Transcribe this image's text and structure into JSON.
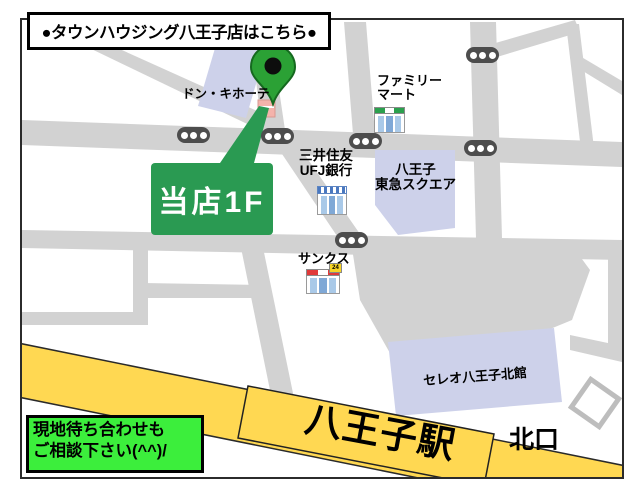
{
  "title_box": {
    "text": "●タウンハウジング八王子店はこちら●"
  },
  "bubble": {
    "label": "当店1F"
  },
  "note_box": {
    "line1": "現地待ち合わせも",
    "line2": "ご相談下さい(^^)/"
  },
  "station": {
    "name": "八王子駅",
    "exit": "北口"
  },
  "places": {
    "don_quijote": "ドン・キホーテ",
    "family_mart": {
      "line1": "ファミリー",
      "line2": "マート"
    },
    "bank": {
      "line1": "三井住友",
      "line2": "UFJ銀行"
    },
    "tokyu_square": {
      "line1": "八王子",
      "line2": "東急スクエア"
    },
    "sunkus": "サンクス",
    "sunkus_badge": "24",
    "celeo": "セレオ八王子北館"
  },
  "colors": {
    "road": "#D2D2D2",
    "building": "#CDD1EA",
    "rail-yellow": "#FFD852",
    "bubble-green": "#2A9A52",
    "pin-green": "#2BA135",
    "pin-dark": "#15691F",
    "note-green": "#3CEE3C",
    "traffic": "#4D4D4D",
    "win-blue": "#A9C9E8",
    "fm-green": "#2AA04D",
    "sunkus-red": "#E03A3A",
    "badge-yellow": "#F7D426",
    "border-dark": "#2B2B2B"
  }
}
